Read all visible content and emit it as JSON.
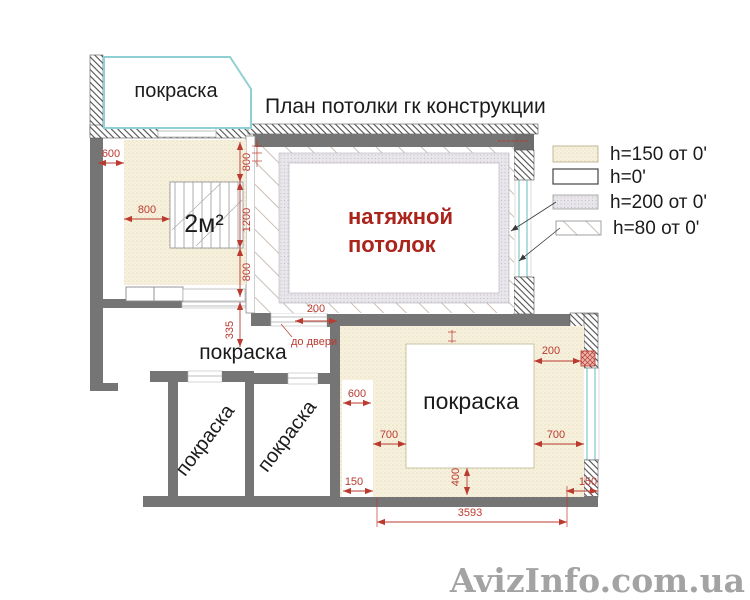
{
  "title": "План потолки гк конструкции",
  "watermark": "AvizInfo.com.ua",
  "legend": [
    {
      "label": "h=150 от 0'",
      "swatch": "beige-dotted"
    },
    {
      "label": "h=0'",
      "swatch": "white"
    },
    {
      "label": "h=200 от 0'",
      "swatch": "gray-dotted"
    },
    {
      "label": "h=80 от 0'",
      "swatch": "diagonal-hatch"
    }
  ],
  "rooms": {
    "balcony": "покраска",
    "hallway": "покраска",
    "small_room_1": "покраска",
    "small_room_2": "покраска",
    "bottom_room": "покраска",
    "main_room_line1": "натяжной",
    "main_room_line2": "потолок",
    "area_label": "2м²"
  },
  "notes": {
    "door_note": "до двери"
  },
  "dims": {
    "left600": "600",
    "left800": "800",
    "v800a": "800",
    "v1200": "1200",
    "v800b": "800",
    "v335": "335",
    "hall200": "200",
    "br600": "600",
    "br700l": "700",
    "br700r": "700",
    "br200": "200",
    "br150l": "150",
    "br150r": "150",
    "br400": "400",
    "br3593": "3593"
  },
  "colors": {
    "dimension_red": "#bb3a30",
    "label_red": "#ab241c",
    "wall_gray": "#757575",
    "window_cyan": "#8fd0d4",
    "beige_fill": "#f6f0dc",
    "gray_band_fill": "#e8e6ea"
  }
}
